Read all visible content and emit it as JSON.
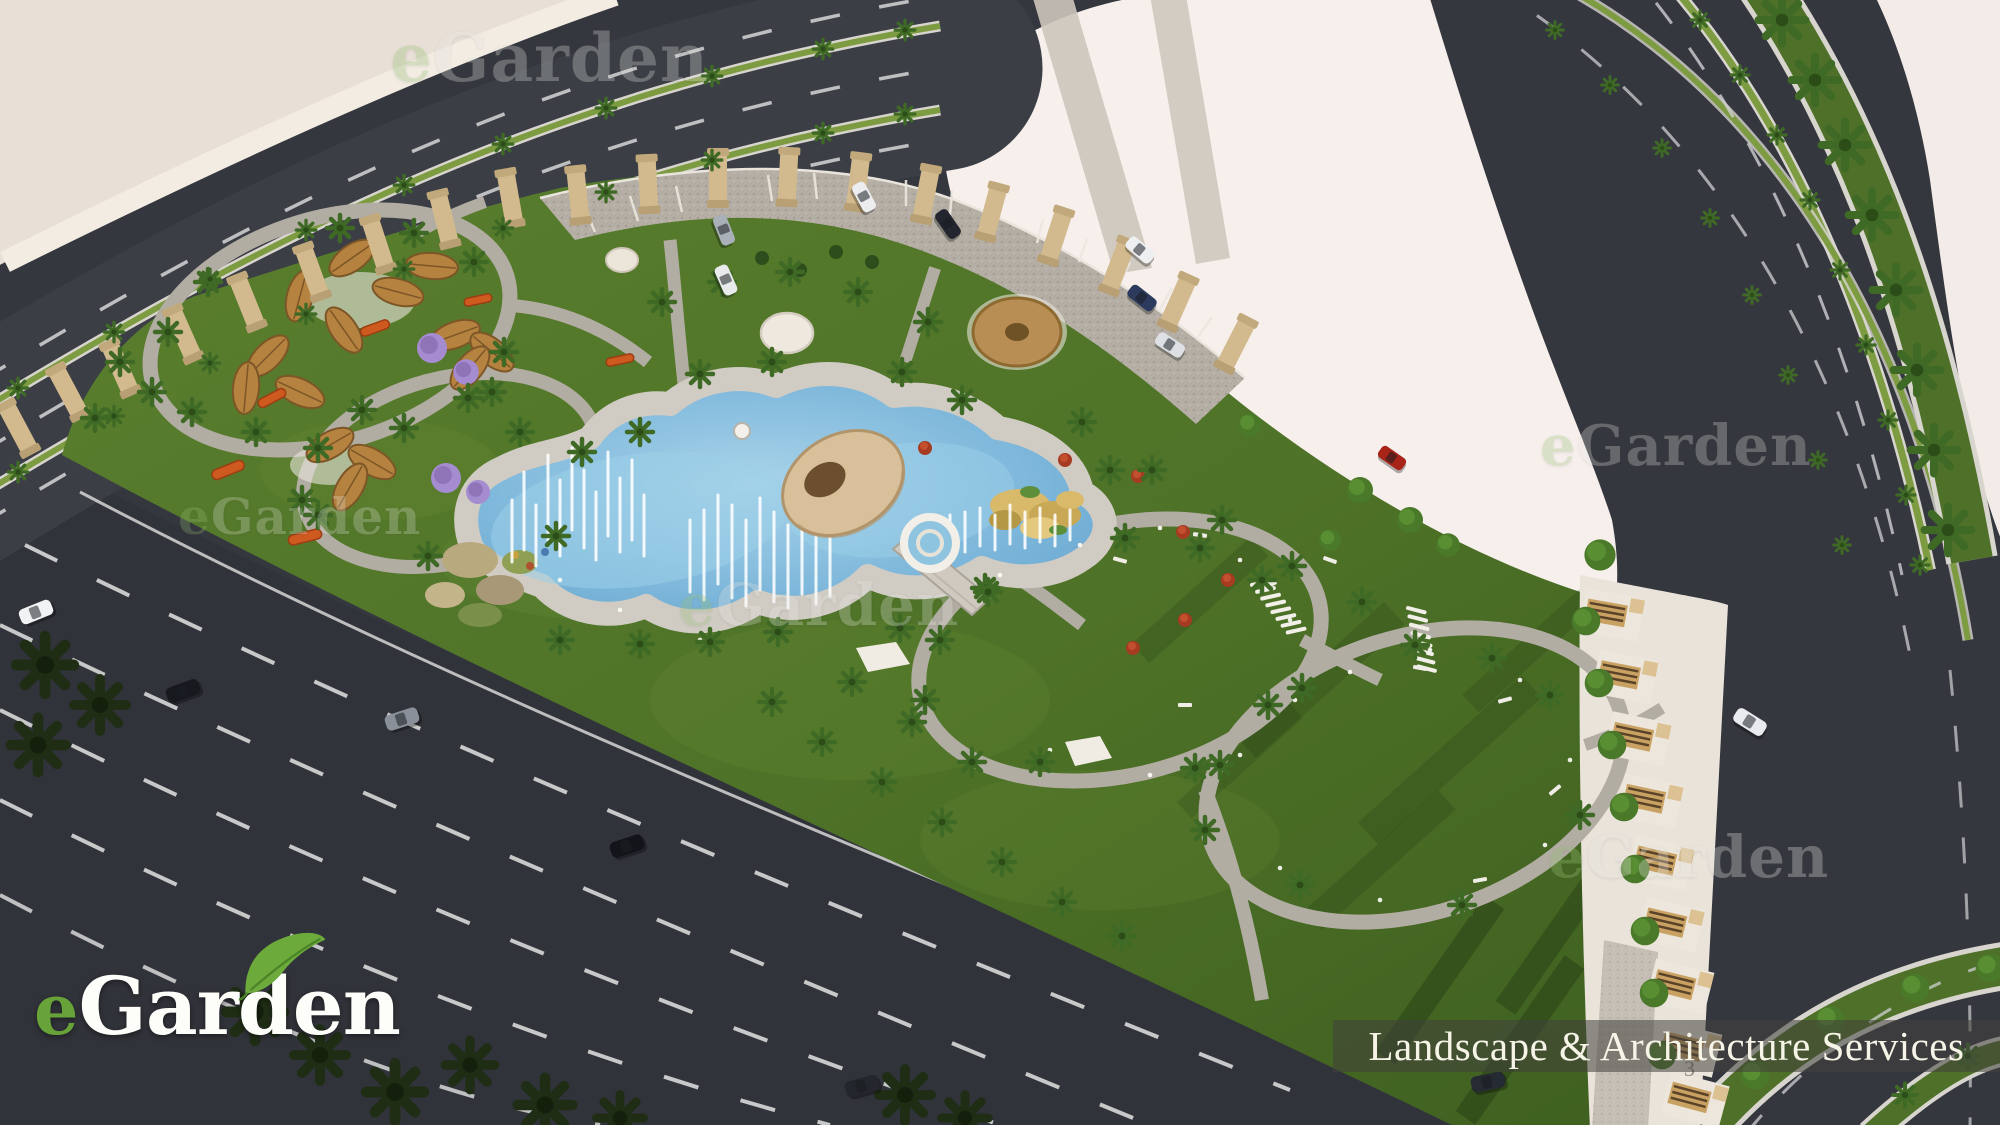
{
  "brand": {
    "logo_text_e": "e",
    "logo_text_rest": "Garden",
    "leaf_icon": "leaf-icon",
    "e_color": "#68a339",
    "text_color": "#fdfdfa",
    "leaf_color": "#6cab3b"
  },
  "banner": {
    "text": "Landscape & Architecture Services",
    "text_color": "#f6f3e7",
    "bg_color": "rgba(66,64,60,0.55)"
  },
  "watermark": {
    "e": "e",
    "rest": "Garden",
    "instances": [
      {
        "x": 390,
        "y": 25,
        "size": 66,
        "opacity": 0.32
      },
      {
        "x": 1540,
        "y": 418,
        "size": 56,
        "opacity": 0.3
      },
      {
        "x": 178,
        "y": 492,
        "size": 50,
        "opacity": 0.28
      },
      {
        "x": 678,
        "y": 576,
        "size": 58,
        "opacity": 0.3
      },
      {
        "x": 1548,
        "y": 828,
        "size": 58,
        "opacity": 0.34
      }
    ]
  },
  "page_number": "3",
  "scene": {
    "description": "Aerial 3D render of a public park landscape design: free-form lake with fountain jets, egg-shaped shade pavilion, ring fountain, walking loop paths, palm trees, leaf-shaped picnic canopies, colonnade, parking plaza and surrounding palm-lined boulevards",
    "colors": {
      "lawn": "#52752a",
      "road": "#35373e",
      "water": "#7cb6da",
      "plaza": "#f6efec",
      "sand": "#e8e0d6",
      "path": "#b3aea4",
      "column": "#d2ba8e",
      "median_green": "#4e7028",
      "canopy_brown": "#b5823f"
    }
  }
}
